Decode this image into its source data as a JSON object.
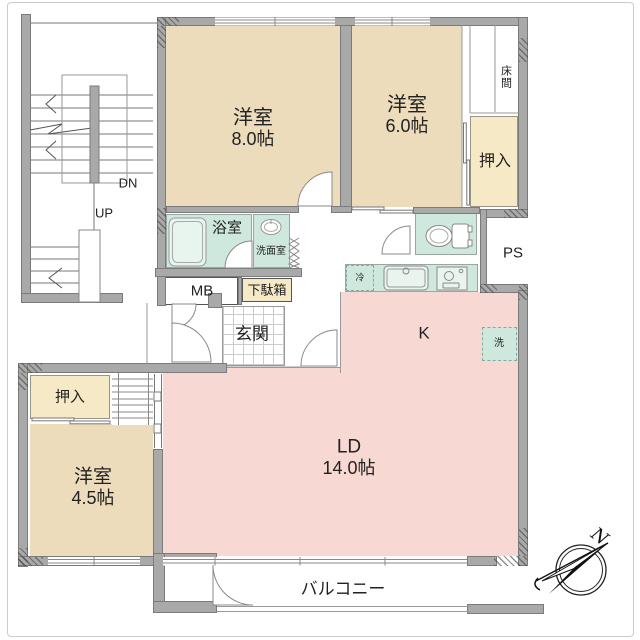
{
  "rooms": {
    "western8": {
      "name": "洋室",
      "size": "8.0帖"
    },
    "western6": {
      "name": "洋室",
      "size": "6.0帖"
    },
    "western45": {
      "name": "洋室",
      "size": "4.5帖"
    },
    "living": {
      "name": "LD",
      "size": "14.0帖"
    },
    "kitchen": {
      "label": "K"
    },
    "bath": {
      "label": "浴室"
    },
    "washroom": {
      "label": "洗面室"
    },
    "genkan": {
      "label": "玄関"
    },
    "tokonoma": {
      "label": "床間"
    },
    "closet_right": {
      "label": "押入"
    },
    "closet_left": {
      "label": "押入"
    },
    "shoe_cabinet": {
      "label": "下駄箱"
    },
    "meter_box": {
      "label": "MB"
    },
    "pipe_space": {
      "label": "PS"
    },
    "balcony": {
      "label": "バルコニー"
    }
  },
  "fixtures": {
    "fridge": {
      "label": "冷"
    },
    "washer": {
      "label": "洗"
    }
  },
  "stairs": {
    "down_label": "DN",
    "up_label": "UP"
  },
  "compass": {
    "north_label": "N"
  },
  "colors": {
    "wall": "#a9a9a9",
    "room_beige": "#ecdcbc",
    "closet_yellow": "#f5e9c6",
    "wet_area_teal": "#cfe8dd",
    "living_pink": "#f8d8d2"
  }
}
